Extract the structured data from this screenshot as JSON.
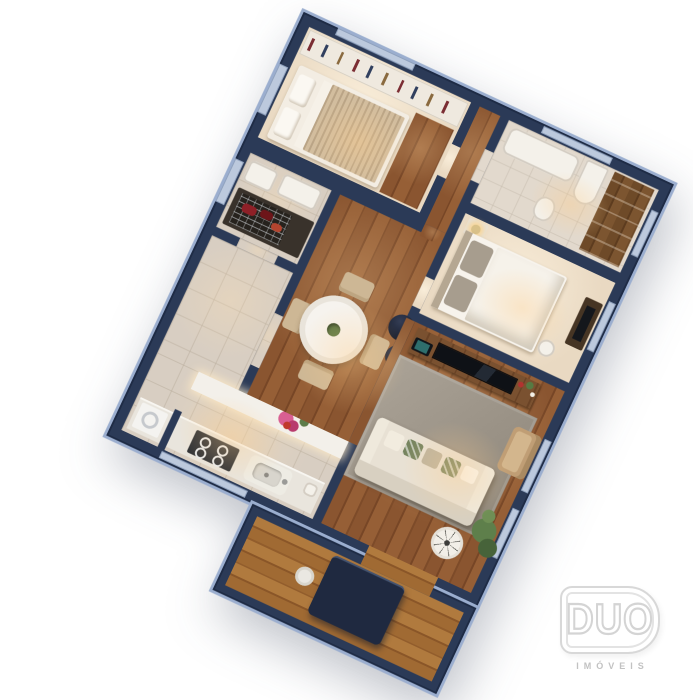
{
  "branding": {
    "logo_text": "DUO",
    "logo_subtext": "IMÓVEIS"
  },
  "scene": {
    "description": "3D isometric floor-plan render of a two-bedroom apartment, rotated view on white background",
    "rooms": [
      "bedroom-1",
      "bathroom",
      "suite-bedroom",
      "hallway",
      "barbecue-nook",
      "kitchen",
      "dining-area",
      "living-room",
      "balcony-deck"
    ],
    "furniture": [
      "wardrobe",
      "double-bed",
      "bathtub",
      "vanity",
      "toilet",
      "suite-bed",
      "nightstand",
      "tv-dresser",
      "grill",
      "washing-machine",
      "cooktop",
      "kitchen-sink",
      "round-dining-table",
      "dining-chairs",
      "sideboard-flowers",
      "tv-rack",
      "television",
      "tablet",
      "sofa",
      "armchair",
      "ottomans",
      "rug",
      "side-table",
      "plants",
      "balcony-table",
      "stool"
    ],
    "colors": {
      "background": "#ffffff",
      "walls": "#2b3a57",
      "wall_top_highlight": "#9baecf",
      "wood_floor": "#8a5530",
      "deck_wood": "#a06a33",
      "tile_floor": "#d8cec2",
      "carpet": "#f0e2cd",
      "rug": "#a09788",
      "sofa": "#e8e1d4",
      "accent_flower_pink": "#d95f92",
      "grill_meat_red": "#8e2027",
      "ottoman_navy": "#1f2637"
    }
  }
}
